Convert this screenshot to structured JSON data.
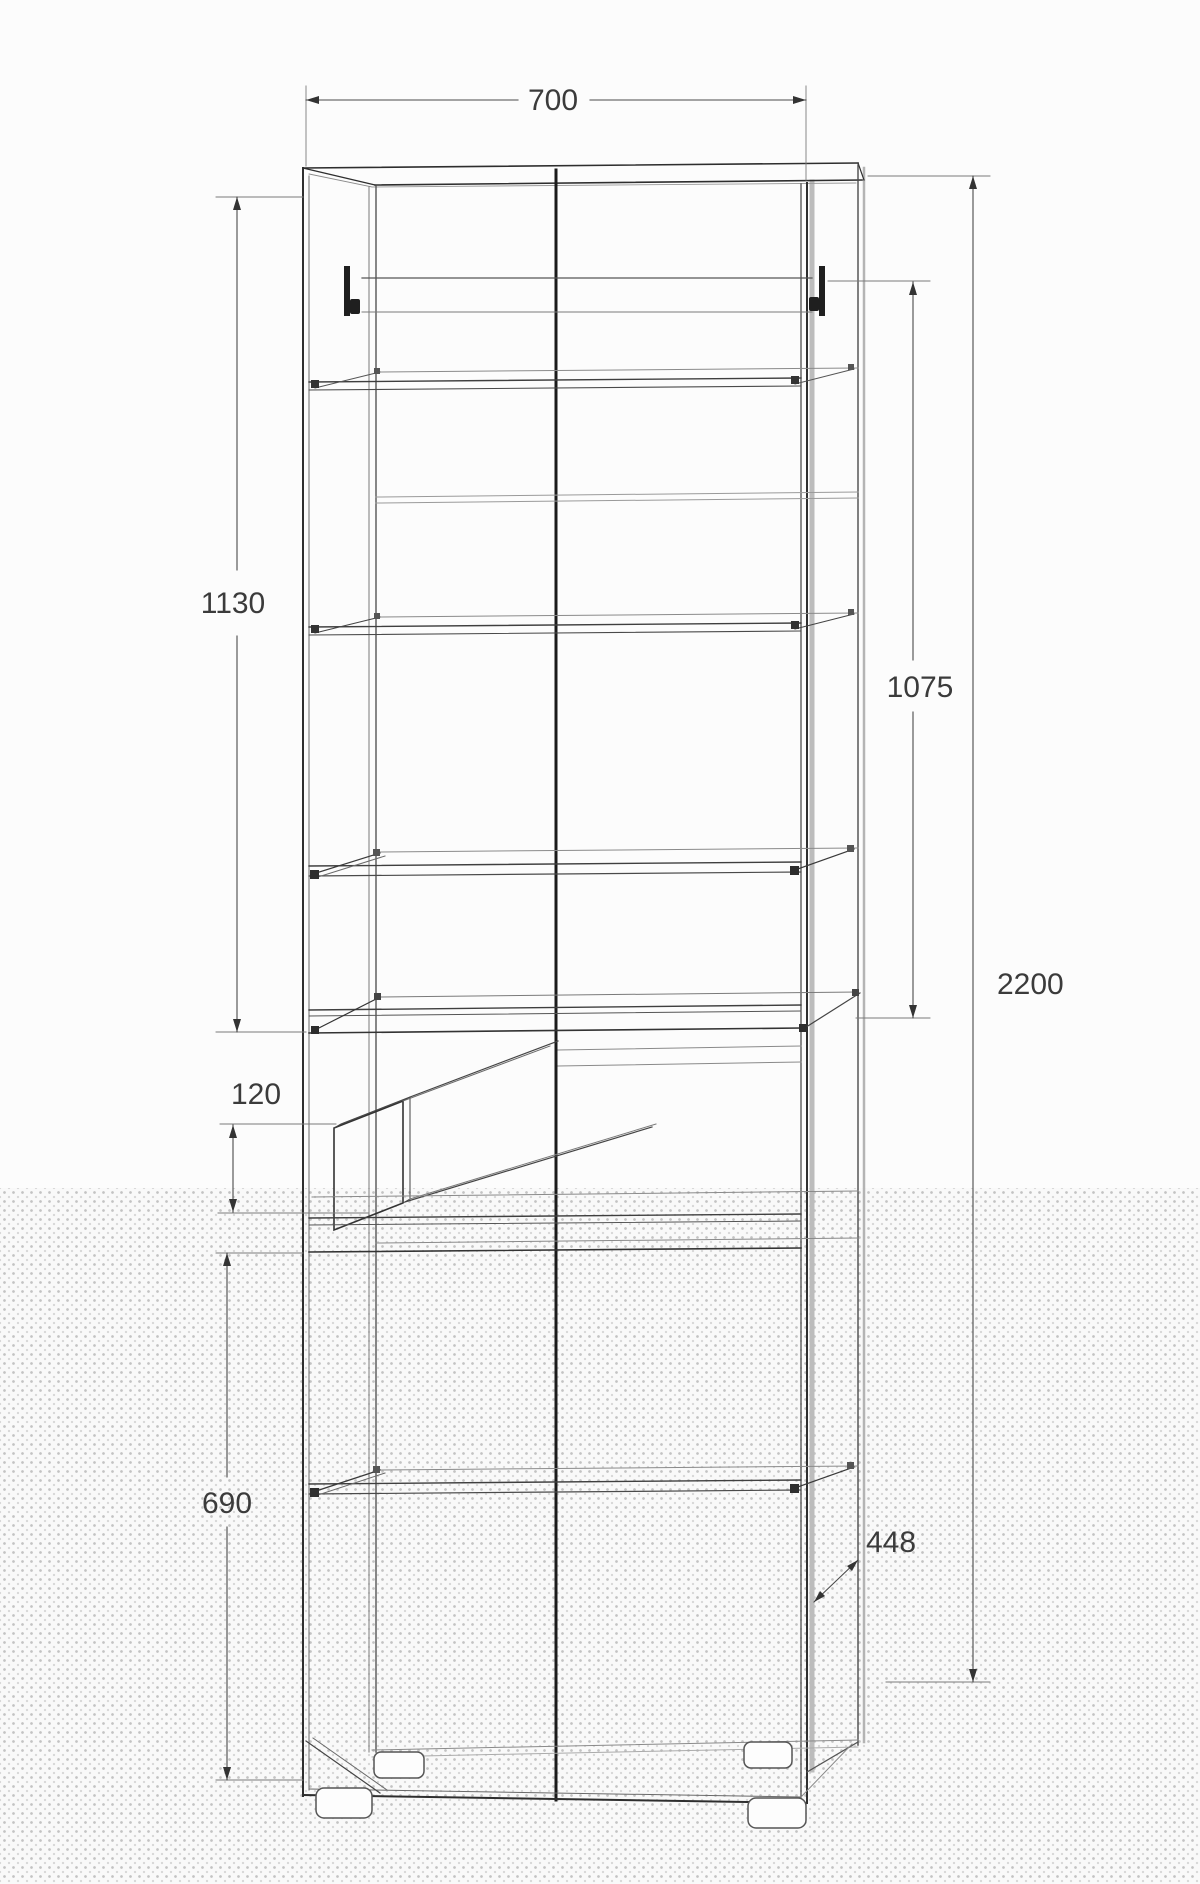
{
  "drawing": {
    "type": "furniture-technical-drawing",
    "subject": "tall-cabinet-with-shelves-and-open-drawer",
    "dimensions": {
      "width_top": "700",
      "upper_section_height": "1130",
      "upper_door_height": "1075",
      "total_height": "2200",
      "drawer_front_height": "120",
      "lower_section_height": "690",
      "depth": "448"
    },
    "colors": {
      "edge_dark": "#2e2e2e",
      "edge_mid": "#4a4a4a",
      "edge_light": "#8a8a8a",
      "dimension_line": "#4a4a4a",
      "label_text": "#3b3b3b",
      "halftone_dot": "#c3c3c3",
      "background": "#fcfcfc"
    }
  }
}
